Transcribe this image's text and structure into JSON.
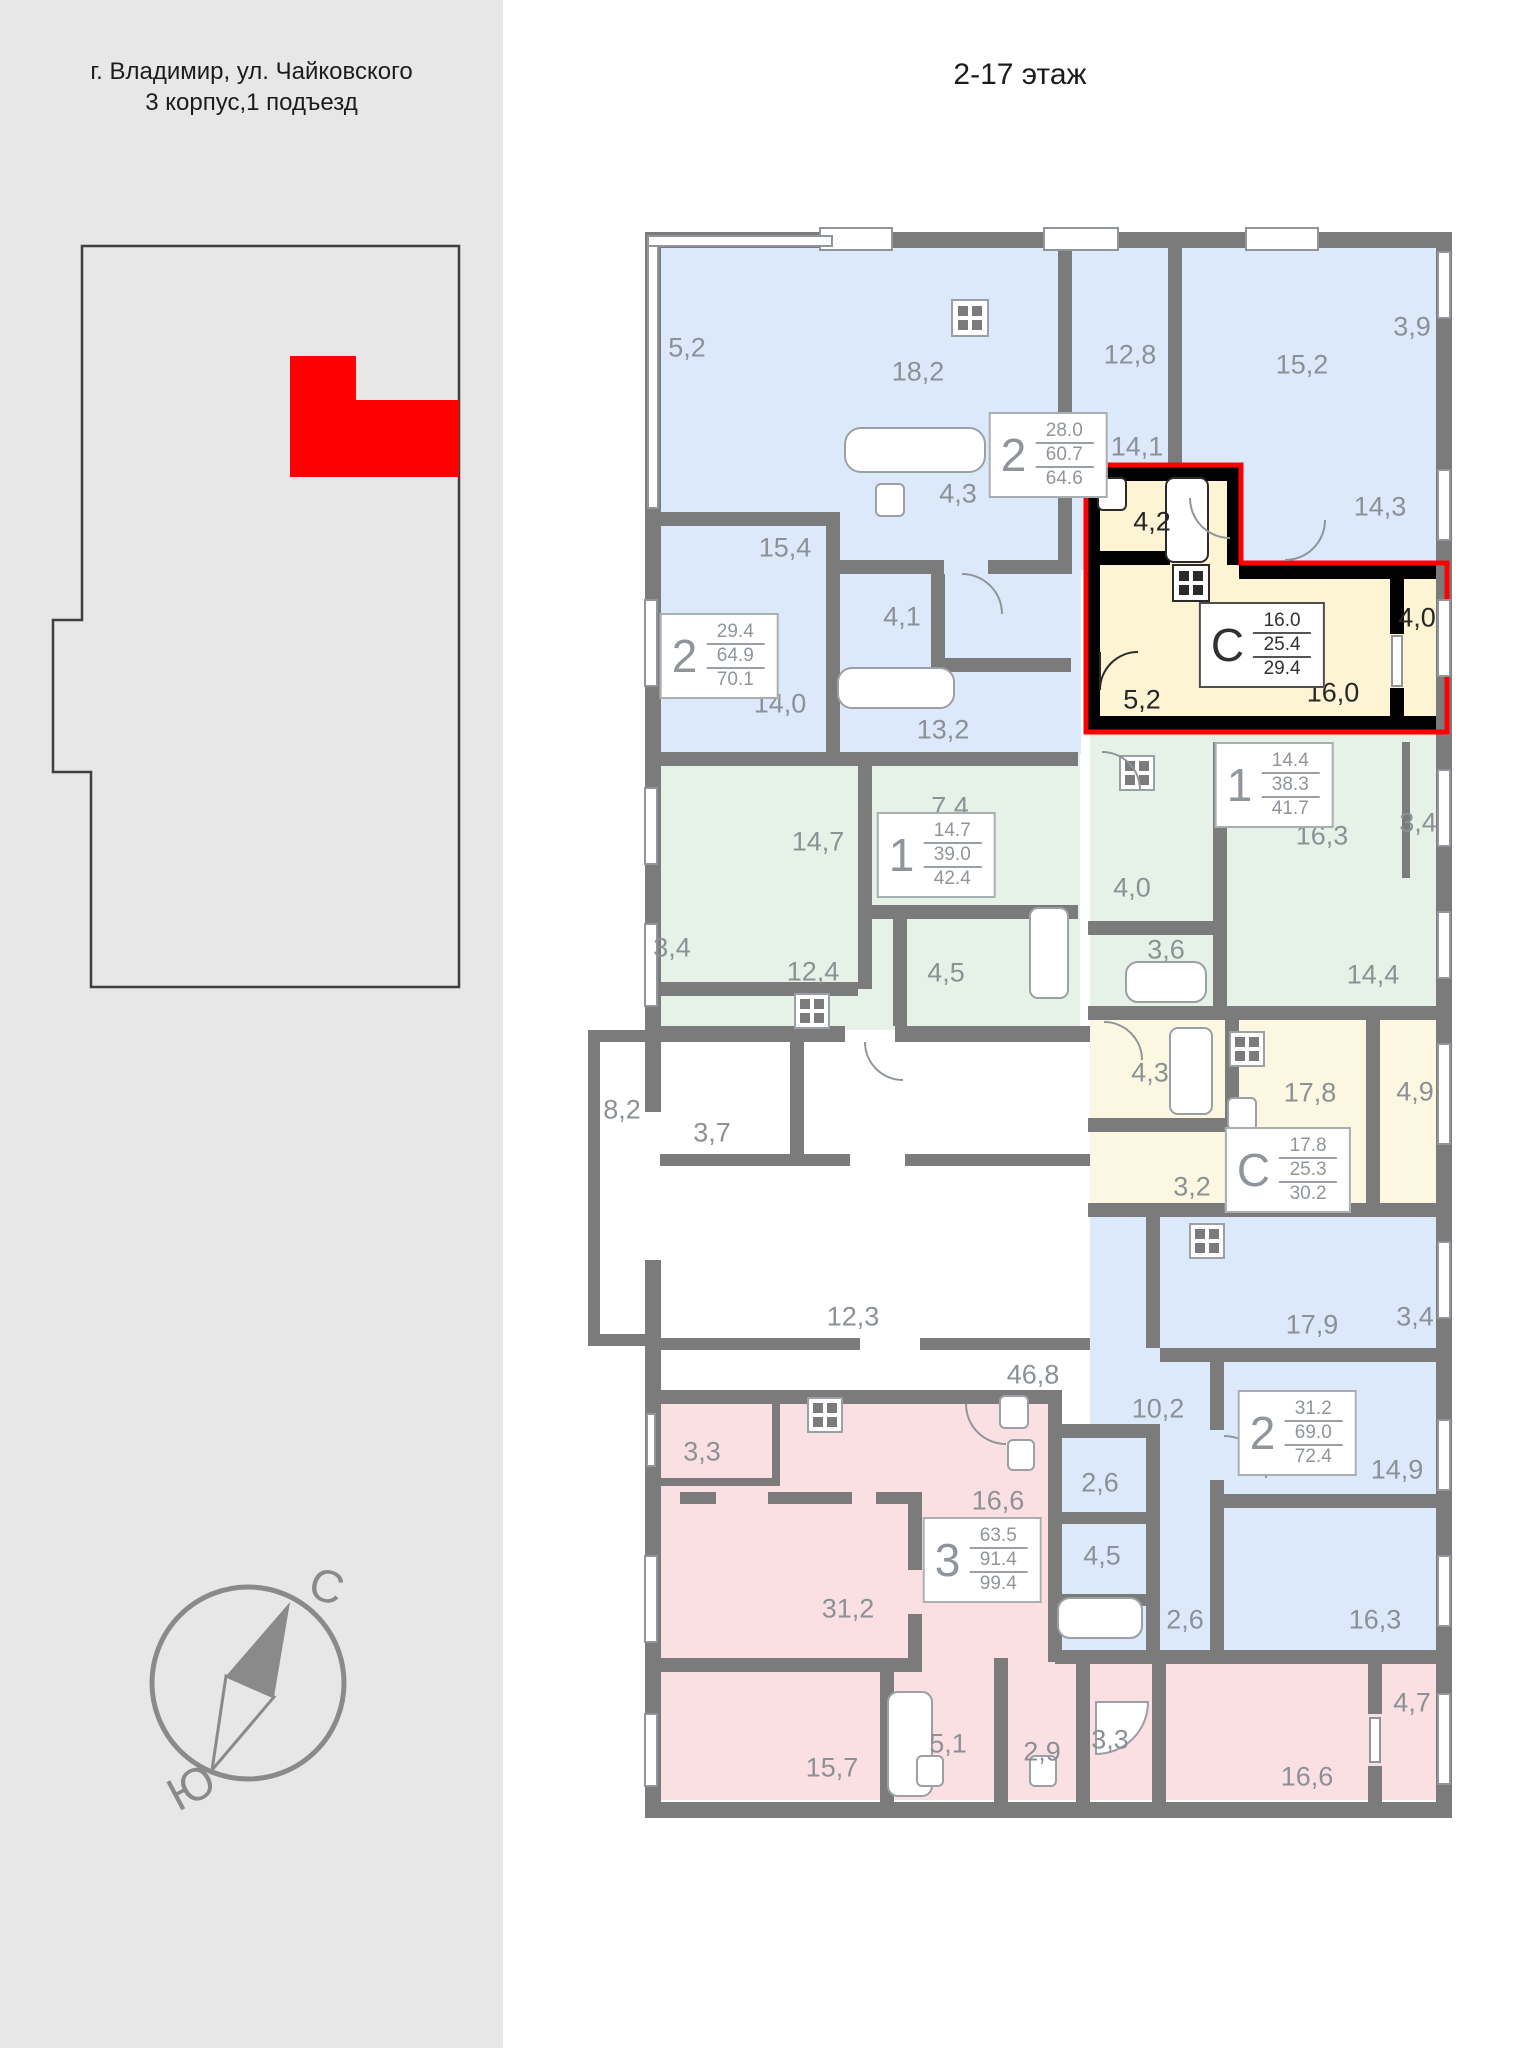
{
  "header": {
    "title": "2-17 этаж"
  },
  "left_panel": {
    "address_line1": "г. Владимир, ул. Чайковского",
    "address_line2": "3 корпус,1 подъезд",
    "compass_north": "С",
    "compass_south": "Ю"
  },
  "colors": {
    "highlight_red": "#fe0000",
    "wall_gray": "#7b7b7b",
    "highlight_wall_black": "#000000",
    "room_blue": "#dbe9fa",
    "room_green": "#e6f2e7",
    "room_yellow_highlight": "#fdf4d3",
    "room_yellow": "#fcf7e0",
    "room_pink": "#fadfe3",
    "panel_gray": "#e7e7e7",
    "label_gray": "#8b9196"
  },
  "apartments": [
    {
      "type": "2",
      "living": "28.0",
      "area": "60.7",
      "total": "64.6",
      "highlighted": false
    },
    {
      "type": "2",
      "living": "29.4",
      "area": "64.9",
      "total": "70.1",
      "highlighted": false
    },
    {
      "type": "1",
      "living": "14.7",
      "area": "39.0",
      "total": "42.4",
      "highlighted": false
    },
    {
      "type": "С",
      "living": "16.0",
      "area": "25.4",
      "total": "29.4",
      "highlighted": true
    },
    {
      "type": "1",
      "living": "14.4",
      "area": "38.3",
      "total": "41.7",
      "highlighted": false
    },
    {
      "type": "С",
      "living": "17.8",
      "area": "25.3",
      "total": "30.2",
      "highlighted": false
    },
    {
      "type": "2",
      "living": "31.2",
      "area": "69.0",
      "total": "72.4",
      "highlighted": false
    },
    {
      "type": "3",
      "living": "63.5",
      "area": "91.4",
      "total": "99.4",
      "highlighted": false
    }
  ],
  "room_labels": [
    "5,2",
    "18,2",
    "4,3",
    "15,4",
    "4,1",
    "14,0",
    "13,2",
    "12,8",
    "15,2",
    "3,9",
    "14,1",
    "14,3",
    "4,2",
    "4,0",
    "16,0",
    "5,2",
    "7,4",
    "14,7",
    "16,3",
    "3,4",
    "3,4",
    "12,4",
    "4,5",
    "4,0",
    "3,6",
    "14,4",
    "8,2",
    "3,7",
    "4,3",
    "17,8",
    "4,9",
    "3,2",
    "12,3",
    "46,8",
    "17,9",
    "3,4",
    "10,2",
    "3,3",
    "16,6",
    "2,6",
    "31,2",
    "14,9",
    "4,5",
    "2,6",
    "16,3",
    "15,7",
    "5,1",
    "2,9",
    "3,3",
    "16,6",
    "4,7"
  ]
}
